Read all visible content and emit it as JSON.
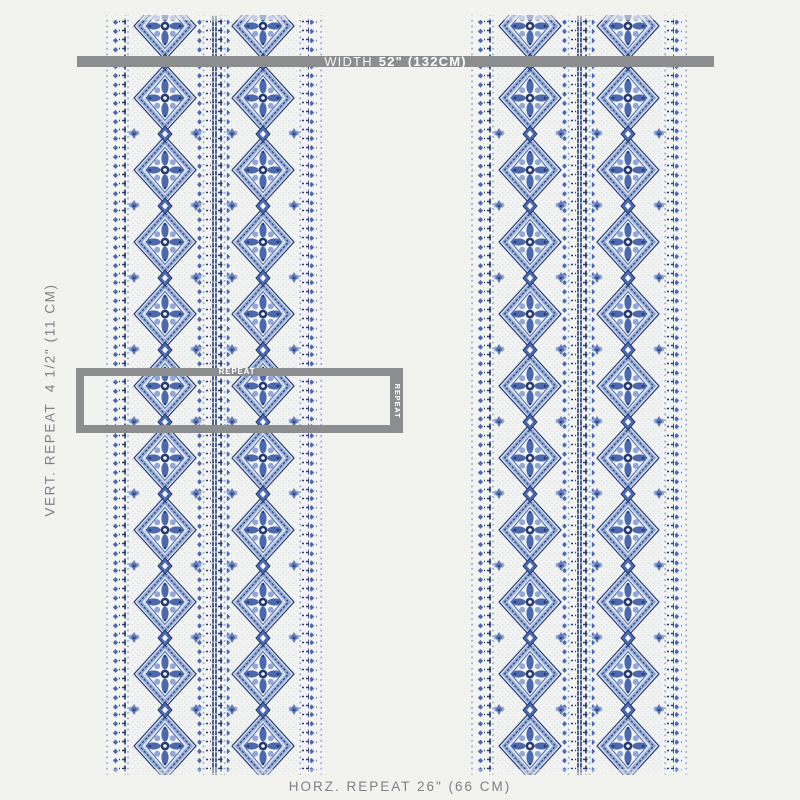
{
  "measurements": {
    "width_bar": {
      "prefix": "WIDTH",
      "value": "52\" (132CM)"
    },
    "vertical_repeat": "VERT. REPEAT  4 1/2\" (11 CM)",
    "horizontal_repeat": "HORZ. REPEAT 26\" (66 CM)",
    "repeat_box": {
      "top_label": "REPEAT",
      "side_label": "REPEAT"
    }
  },
  "colors": {
    "page-bg": "#f2f2ef",
    "bar-gray": "#8b8d8e",
    "label-gray": "#7e8184",
    "fabric-navy": "#263a72",
    "fabric-mid-blue": "#4c69ab",
    "fabric-light-blue": "#93a9d4",
    "fabric-pale-blue": "#dce4f2",
    "fabric-ground": "#f3f4f1"
  }
}
